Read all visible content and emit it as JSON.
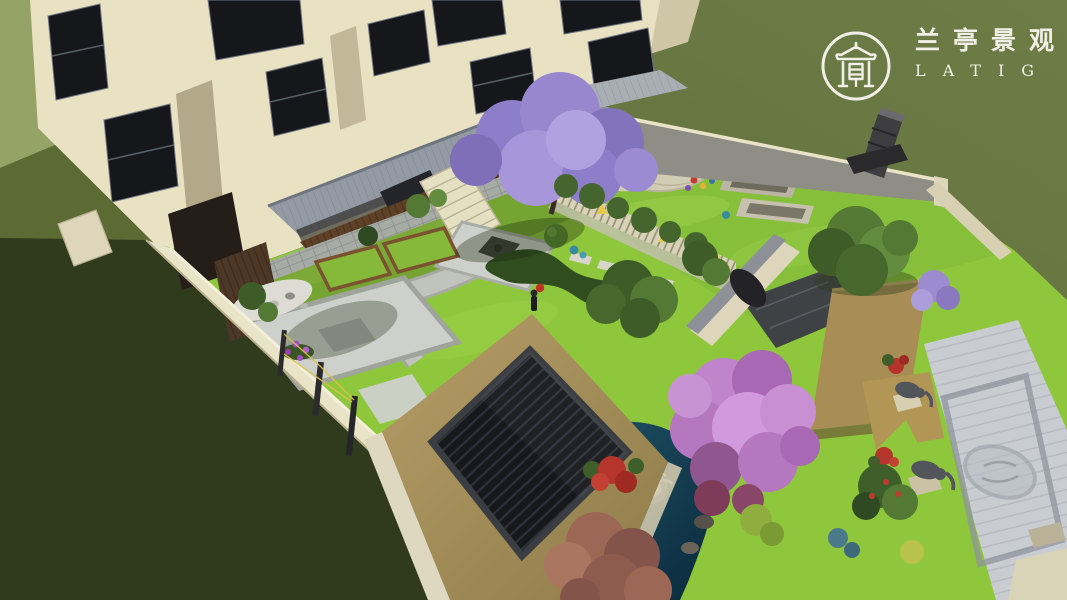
{
  "logo": {
    "chinese": "兰亭景观",
    "latin": "LATIG",
    "icon": "pavilion-seal-icon"
  },
  "palette": {
    "ground_olive": "#6e7c46",
    "ground_olive_deep": "#596838",
    "ground_light": "#96a366",
    "ground_shadow": "#2f3b1c",
    "lawn": "#8fc73c",
    "lawn_light": "#a5d44f",
    "wall_cream": "#e9e3c8",
    "wall_cap": "#f4efdb",
    "wall_gray": "#8e8e86",
    "facade": "#e8e1c2",
    "facade_shade": "#c9bfa0",
    "window": "#16171b",
    "roof_gray": "#939aa3",
    "railing_brown": "#5d4026",
    "stone_base": "#a7aba6",
    "path": "#c0c4bd",
    "patio": "#ced1cb",
    "gravel": "#dcdcd4",
    "soil_frame": "#7b5230",
    "pond": "#1b4a60",
    "pond_deep": "#0c2e40",
    "bronze": "#a3894f",
    "louver": "#17181c",
    "jacaranda": "#9887cf",
    "pink_tree": "#c084cc",
    "rust_tree": "#9c6754",
    "tree_green": "#537934",
    "hedge": "#42632c",
    "flower_red": "#b5342b",
    "canopy_tan": "#a88d55",
    "walkway": "#c9ccd1",
    "statue_gray": "#52555a",
    "lamp_yellow": "#e7c84a",
    "fountain_white": "#eef4f6",
    "logo_white": "#f7f5ef"
  }
}
